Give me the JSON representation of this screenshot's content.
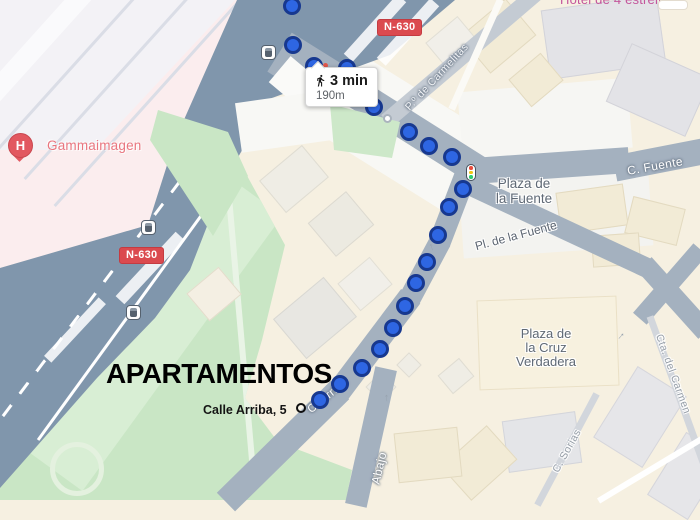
{
  "tooltip": {
    "duration": "3 min",
    "distance": "190m"
  },
  "badge": {
    "label": "N-630"
  },
  "pois": {
    "hotel": "Hotel de 4 estrellas",
    "hospital": "Gammaimagen",
    "hospital_letter": "H",
    "apartments": "APARTAMENTOS",
    "address": "Calle Arriba, 5"
  },
  "areas": {
    "plaza_fuente": "Plaza de\nla Fuente",
    "pl_fuente": "Pl. de la Fuente",
    "plaza_cruz": "Plaza de\nla Cruz\nVerdadera"
  },
  "streets": {
    "carmelitas": "P.º de Carmelitas",
    "fuente": "C. Fuente",
    "arriba": "C. Arriba",
    "abajo": "Abajo",
    "carmen": "Cta. del Carmen",
    "sorias": "C. Sorias"
  },
  "route": {
    "dots": [
      [
        292,
        6
      ],
      [
        293,
        45
      ],
      [
        314,
        66
      ],
      [
        347,
        68
      ],
      [
        374,
        107
      ],
      [
        409,
        132
      ],
      [
        429,
        146
      ],
      [
        452,
        157
      ],
      [
        463,
        189
      ],
      [
        449,
        207
      ],
      [
        438,
        235
      ],
      [
        427,
        262
      ],
      [
        416,
        283
      ],
      [
        405,
        306
      ],
      [
        393,
        328
      ],
      [
        380,
        349
      ],
      [
        362,
        368
      ],
      [
        340,
        384
      ],
      [
        320,
        400
      ]
    ]
  },
  "transit": {
    "bus_stops": [
      [
        268,
        52
      ],
      [
        148,
        227
      ],
      [
        133,
        312
      ]
    ]
  },
  "arrows": [
    [
      433,
      248,
      -18
    ],
    [
      388,
      399,
      -4
    ],
    [
      622,
      337,
      42
    ]
  ],
  "colors": {
    "route_dot": "#2E66E3",
    "route_dot_border": "#17388F",
    "badge_red": "#DB4A4F",
    "highway": "#8096AC",
    "minor_road": "#A4B1BF",
    "park_green": "#C9E6C5",
    "hospital_pink": "#FBEDEE",
    "cream": "#F6F0E1",
    "hotel_label": "#C4559B",
    "hospital_label": "#E9767F"
  }
}
